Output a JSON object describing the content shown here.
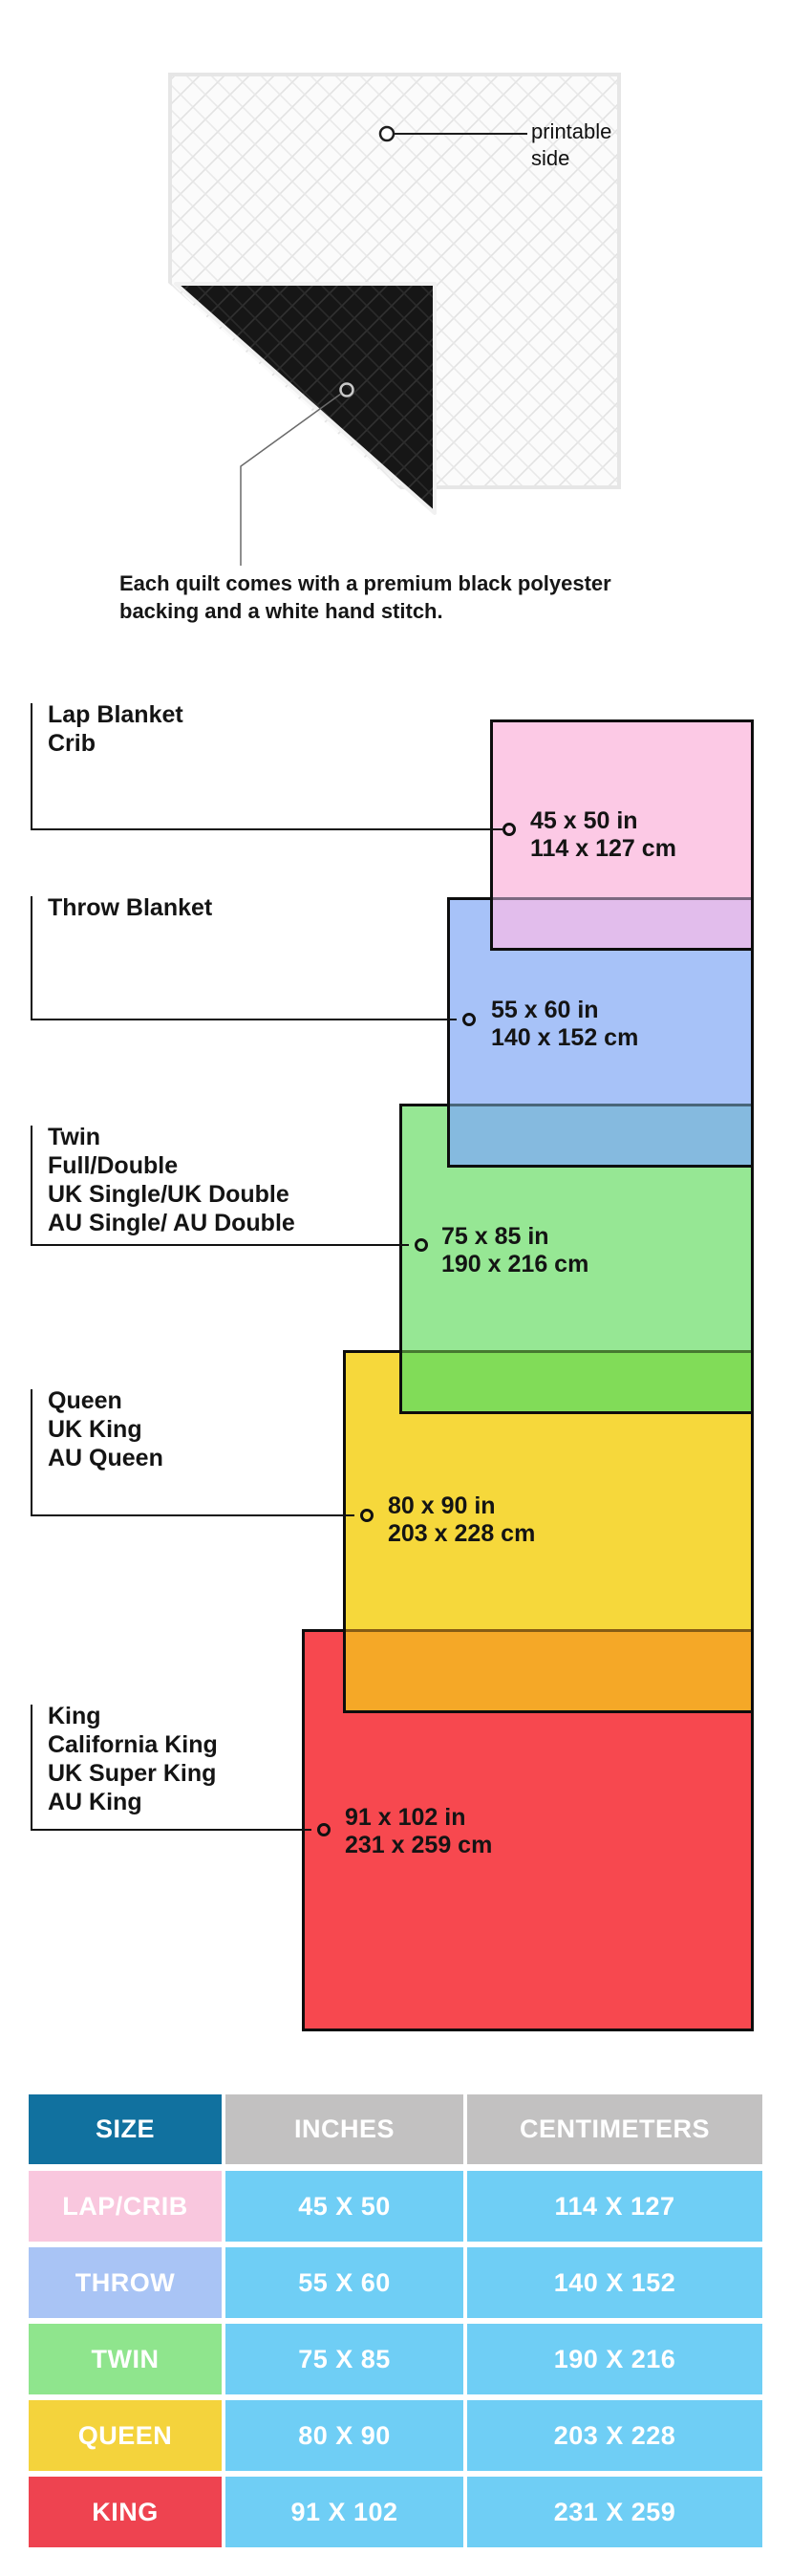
{
  "quilt": {
    "printable_label_line1": "printable",
    "printable_label_line2": "side",
    "caption_line1": "Each quilt comes with a premium black polyester",
    "caption_line2": "backing and a white hand stitch.",
    "front_color": "#fbfbfb",
    "backing_color": "#161616"
  },
  "diagram": {
    "groups": [
      {
        "id": "lap",
        "labels": [
          "Lap Blanket",
          "Crib"
        ],
        "inches": "45 x 50 in",
        "cm": "114 x 127 cm",
        "color": "#fcc9e5",
        "overlap_color": "#e2bdec"
      },
      {
        "id": "throw",
        "labels": [
          "Throw Blanket"
        ],
        "inches": "55 x 60 in",
        "cm": "140 x 152 cm",
        "color": "#a7c2f8",
        "overlap_color": "#85badf"
      },
      {
        "id": "twin",
        "labels": [
          "Twin",
          "Full/Double",
          "UK Single/UK Double",
          "AU Single/ AU Double"
        ],
        "inches": "75 x 85 in",
        "cm": "190 x 216 cm",
        "color": "#96e794",
        "overlap_color": "#81dc58"
      },
      {
        "id": "queen",
        "labels": [
          "Queen",
          "UK King",
          "AU Queen"
        ],
        "inches": "80 x 90 in",
        "cm": "203 x 228 cm",
        "color": "#f6d83b",
        "overlap_color": "#f5a827"
      },
      {
        "id": "king",
        "labels": [
          "King",
          "California King",
          "UK Super King",
          "AU King"
        ],
        "inches": "91 x 102 in",
        "cm": "231 x 259 cm",
        "color": "#f7484f",
        "overlap_color": null
      }
    ]
  },
  "table": {
    "headers": [
      "SIZE",
      "INCHES",
      "CENTIMETERS"
    ],
    "size_header_bg": "#11719f",
    "measure_header_bg": "#c2c1c1",
    "value_cell_bg": "#6fcef5",
    "rows": [
      {
        "size": "LAP/CRIB",
        "inches": "45 X 50",
        "cm": "114 X 127",
        "color": "#f9c7de"
      },
      {
        "size": "THROW",
        "inches": "55 X 60",
        "cm": "140 X 152",
        "color": "#a9c4f5"
      },
      {
        "size": "TWIN",
        "inches": "75 X 85",
        "cm": "190 X 216",
        "color": "#8fe58d"
      },
      {
        "size": "QUEEN",
        "inches": "80 X 90",
        "cm": "203 X 228",
        "color": "#f4d33c"
      },
      {
        "size": "KING",
        "inches": "91 X 102",
        "cm": "231 X 259",
        "color": "#ee4350"
      }
    ]
  }
}
